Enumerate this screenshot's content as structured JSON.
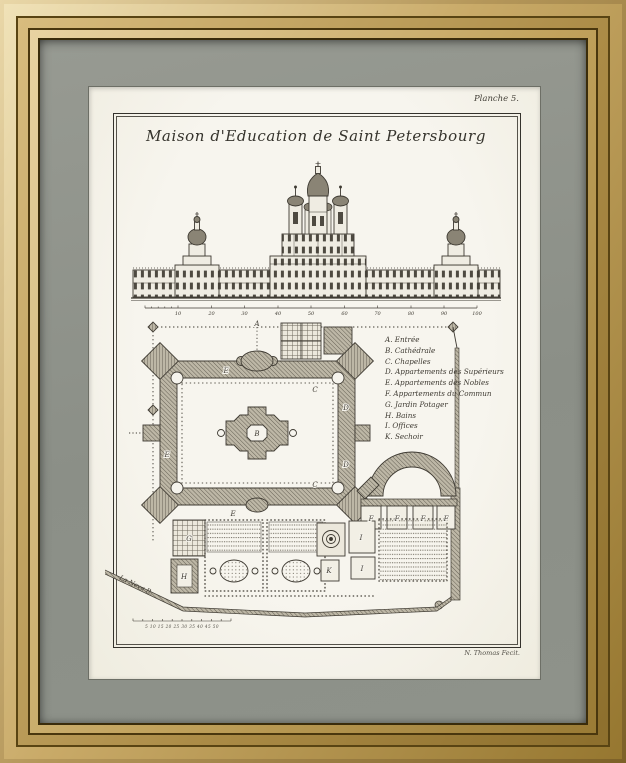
{
  "artwork": {
    "plate_number": "Planche 5.",
    "title": "Maison d'Education de Saint Petersbourg",
    "signature": "N. Thomas Fecit.",
    "river_label": "La Neva R.",
    "plan_scale_numbers": "5 10 15 20 25 30 35 40 45 50",
    "elevation_scale": [
      "10",
      "20",
      "30",
      "40",
      "50",
      "60",
      "70",
      "80",
      "90",
      "100"
    ],
    "plan_labels": {
      "a": "A",
      "b": "B",
      "c": "C",
      "d": "D",
      "e": "E",
      "f": "F",
      "g": "G",
      "h": "H",
      "i": "I",
      "k": "K"
    },
    "legend": [
      "A. Entrée",
      "B. Cathédrale",
      "C. Chapelles",
      "D. Appartements des Supérieurs",
      "E. Appartements des Nobles",
      "F. Appartements du Commun",
      "G. Jardin Potager",
      "H. Bains",
      "I. Offices",
      "K. Sechoir"
    ],
    "colors": {
      "frame_gold": "#c2a35f",
      "mat_grey": "#8f938c",
      "paper": "#f5f3ea",
      "ink": "#3e3a32"
    }
  }
}
